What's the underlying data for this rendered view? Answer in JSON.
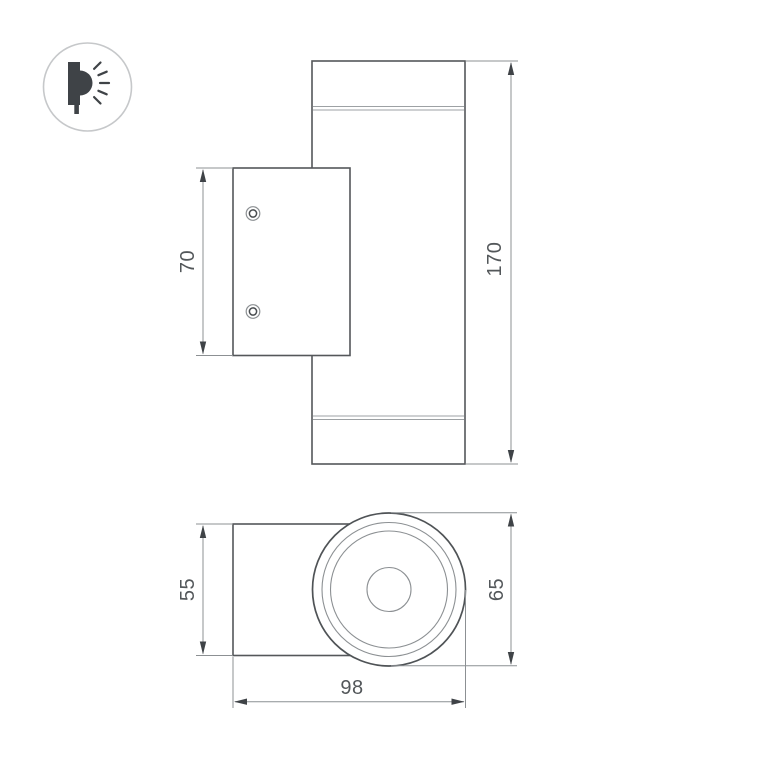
{
  "icon": {
    "name": "wall-mounted-light-side-emission-icon"
  },
  "colors": {
    "background": "#ffffff",
    "outline": "#54575a",
    "dimension_line": "#8c9093",
    "seam_line": "#9da1a4",
    "text": "#53575a",
    "arrow": "#3f4347",
    "icon_glyph": "#3f4347",
    "icon_border": "#c6c8ca"
  },
  "front_view": {
    "overall_height": "170",
    "bracket_height": "70"
  },
  "bottom_view": {
    "overall_depth": "98",
    "head_diameter": "65",
    "bracket_depth": "55"
  }
}
